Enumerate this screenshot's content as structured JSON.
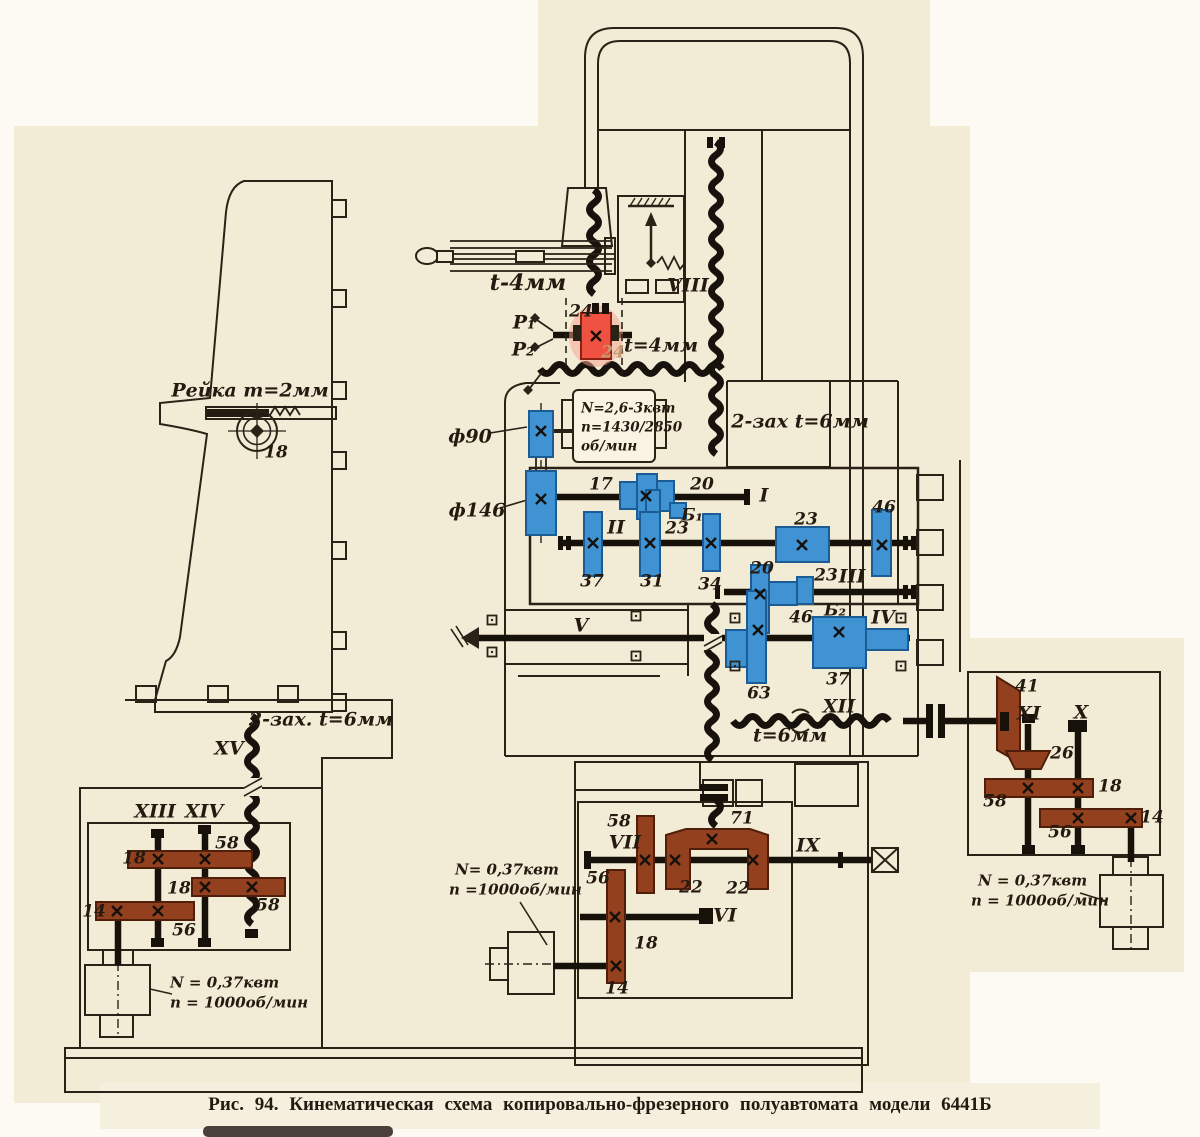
{
  "figure": {
    "caption": "Рис. 94. Кинематическая схема копировально-фрезерного полуавтомата модели 6441Б"
  },
  "colors": {
    "paper": "#f2ebd5",
    "ink": "#2a2217",
    "shaft_black": "#171209",
    "gear_blue": "#3f93d3",
    "gear_brown": "#93401e",
    "gear_red": "#ef5241"
  },
  "annotations": {
    "shafts": [
      {
        "t": "I",
        "x": 764,
        "y": 496
      },
      {
        "t": "II",
        "x": 616,
        "y": 528
      },
      {
        "t": "III",
        "x": 852,
        "y": 577
      },
      {
        "t": "IV",
        "x": 883,
        "y": 618
      },
      {
        "t": "V",
        "x": 581,
        "y": 626
      },
      {
        "t": "VI",
        "x": 725,
        "y": 916
      },
      {
        "t": "VII",
        "x": 625,
        "y": 843
      },
      {
        "t": "VIII",
        "x": 688,
        "y": 286
      },
      {
        "t": "IX",
        "x": 808,
        "y": 846
      },
      {
        "t": "X",
        "x": 1081,
        "y": 713
      },
      {
        "t": "XI",
        "x": 1029,
        "y": 714
      },
      {
        "t": "XII",
        "x": 839,
        "y": 707
      },
      {
        "t": "XIII",
        "x": 155,
        "y": 812
      },
      {
        "t": "XIV",
        "x": 204,
        "y": 812
      },
      {
        "t": "XV",
        "x": 229,
        "y": 749
      }
    ],
    "gears": [
      {
        "t": "17",
        "x": 601,
        "y": 485
      },
      {
        "t": "20",
        "x": 702,
        "y": 485
      },
      {
        "t": "Б₁",
        "x": 692,
        "y": 516
      },
      {
        "t": "23",
        "x": 677,
        "y": 529
      },
      {
        "t": "23",
        "x": 806,
        "y": 520
      },
      {
        "t": "46",
        "x": 884,
        "y": 508
      },
      {
        "t": "37",
        "x": 592,
        "y": 582
      },
      {
        "t": "31",
        "x": 652,
        "y": 582
      },
      {
        "t": "34",
        "x": 710,
        "y": 585
      },
      {
        "t": "20",
        "x": 762,
        "y": 569
      },
      {
        "t": "23",
        "x": 826,
        "y": 576
      },
      {
        "t": "46",
        "x": 801,
        "y": 618
      },
      {
        "t": "Б₂",
        "x": 835,
        "y": 611
      },
      {
        "t": "37",
        "x": 838,
        "y": 680
      },
      {
        "t": "63",
        "x": 759,
        "y": 694
      },
      {
        "t": "24",
        "x": 581,
        "y": 312
      },
      {
        "t": "24",
        "x": 613,
        "y": 353,
        "c": "faded"
      },
      {
        "t": "18",
        "x": 276,
        "y": 453
      },
      {
        "t": "58",
        "x": 227,
        "y": 844
      },
      {
        "t": "18",
        "x": 134,
        "y": 859
      },
      {
        "t": "18",
        "x": 179,
        "y": 889
      },
      {
        "t": "58",
        "x": 268,
        "y": 906
      },
      {
        "t": "14",
        "x": 94,
        "y": 912
      },
      {
        "t": "56",
        "x": 184,
        "y": 931
      },
      {
        "t": "58",
        "x": 619,
        "y": 822
      },
      {
        "t": "56",
        "x": 598,
        "y": 879
      },
      {
        "t": "71",
        "x": 742,
        "y": 819
      },
      {
        "t": "22",
        "x": 691,
        "y": 888
      },
      {
        "t": "22",
        "x": 738,
        "y": 889
      },
      {
        "t": "18",
        "x": 646,
        "y": 944
      },
      {
        "t": "14",
        "x": 617,
        "y": 989
      },
      {
        "t": "41",
        "x": 1027,
        "y": 687
      },
      {
        "t": "26",
        "x": 1062,
        "y": 754
      },
      {
        "t": "58",
        "x": 995,
        "y": 802
      },
      {
        "t": "18",
        "x": 1110,
        "y": 787
      },
      {
        "t": "56",
        "x": 1060,
        "y": 833
      },
      {
        "t": "14",
        "x": 1152,
        "y": 818
      }
    ],
    "notes": [
      {
        "t": "t-4мм",
        "x": 528,
        "y": 283,
        "c": "big"
      },
      {
        "t": "t=4мм",
        "x": 661,
        "y": 346
      },
      {
        "t": "Рейка m=2мм",
        "x": 250,
        "y": 391
      },
      {
        "t": "2-зах t=6мм",
        "x": 800,
        "y": 422
      },
      {
        "t": "t=6мм",
        "x": 790,
        "y": 736
      },
      {
        "t": "2-зах. t=6мм",
        "x": 321,
        "y": 720
      },
      {
        "t": "ф90",
        "x": 470,
        "y": 437
      },
      {
        "t": "ф146",
        "x": 477,
        "y": 511
      },
      {
        "t": "P₁",
        "x": 524,
        "y": 323
      },
      {
        "t": "P₂",
        "x": 523,
        "y": 350
      }
    ],
    "motor_specs": [
      {
        "t": "N=2,6-3квт",
        "x": 581,
        "y": 409,
        "c": "sm"
      },
      {
        "t": "n=1430/2850",
        "x": 581,
        "y": 428,
        "c": "sm"
      },
      {
        "t": "об/мин",
        "x": 581,
        "y": 447,
        "c": "sm"
      },
      {
        "t": "N= 0,37квт",
        "x": 455,
        "y": 870
      },
      {
        "t": "n =1000об/мин",
        "x": 449,
        "y": 890
      },
      {
        "t": "N = 0,37квт",
        "x": 170,
        "y": 983
      },
      {
        "t": "n = 1000об/мин",
        "x": 170,
        "y": 1003
      },
      {
        "t": "N = 0,37квт",
        "x": 978,
        "y": 881
      },
      {
        "t": "n = 1000об/мин",
        "x": 971,
        "y": 901
      }
    ]
  }
}
